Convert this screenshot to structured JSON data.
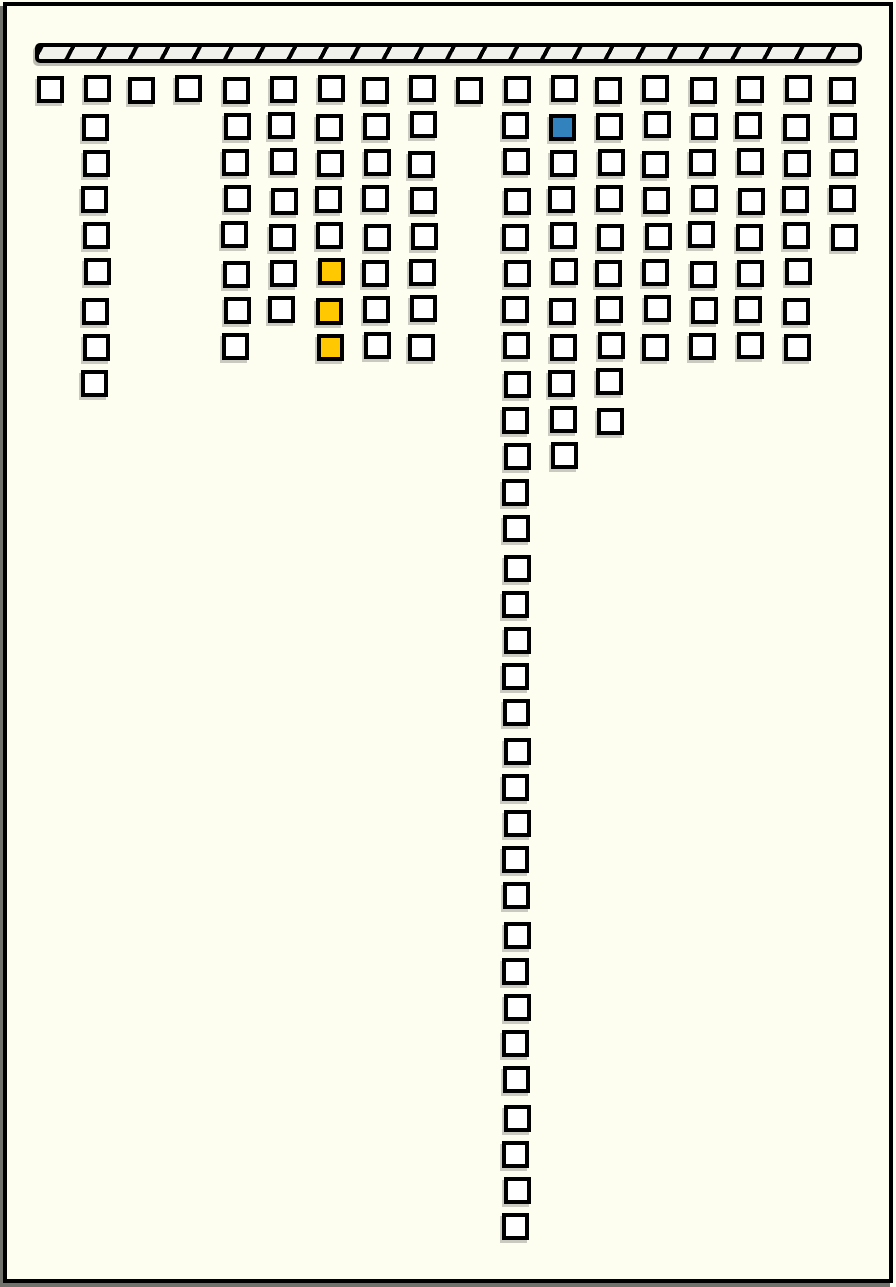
{
  "figure": {
    "kind": "hanging-square-columns-diagram",
    "background_color": "#fdfdf0",
    "frame_color": "#000000",
    "top_bar": {
      "name": "hatched-ceiling-bar",
      "hatch_light": "#f1f1ec",
      "hatch_dark": "#000000"
    },
    "square_style": {
      "fill": "#ffffff",
      "border": "#000000"
    },
    "highlight_colors": {
      "blue": "#3182bd",
      "yellow": "#ffc800"
    },
    "columns": [
      {
        "col": 1,
        "squares": 1,
        "highlights": []
      },
      {
        "col": 2,
        "squares": 9,
        "highlights": []
      },
      {
        "col": 3,
        "squares": 1,
        "highlights": []
      },
      {
        "col": 4,
        "squares": 1,
        "highlights": []
      },
      {
        "col": 5,
        "squares": 8,
        "highlights": []
      },
      {
        "col": 6,
        "squares": 7,
        "highlights": []
      },
      {
        "col": 7,
        "squares": 8,
        "highlights": [
          {
            "row": 6,
            "color": "yellow"
          },
          {
            "row": 7,
            "color": "yellow"
          },
          {
            "row": 8,
            "color": "yellow"
          }
        ]
      },
      {
        "col": 8,
        "squares": 8,
        "highlights": []
      },
      {
        "col": 9,
        "squares": 8,
        "highlights": []
      },
      {
        "col": 10,
        "squares": 1,
        "highlights": []
      },
      {
        "col": 11,
        "squares": 32,
        "highlights": []
      },
      {
        "col": 12,
        "squares": 11,
        "highlights": [
          {
            "row": 2,
            "color": "blue"
          }
        ]
      },
      {
        "col": 13,
        "squares": 10,
        "highlights": []
      },
      {
        "col": 14,
        "squares": 8,
        "highlights": []
      },
      {
        "col": 15,
        "squares": 8,
        "highlights": []
      },
      {
        "col": 16,
        "squares": 8,
        "highlights": []
      },
      {
        "col": 17,
        "squares": 8,
        "highlights": []
      },
      {
        "col": 18,
        "squares": 5,
        "highlights": []
      }
    ]
  }
}
